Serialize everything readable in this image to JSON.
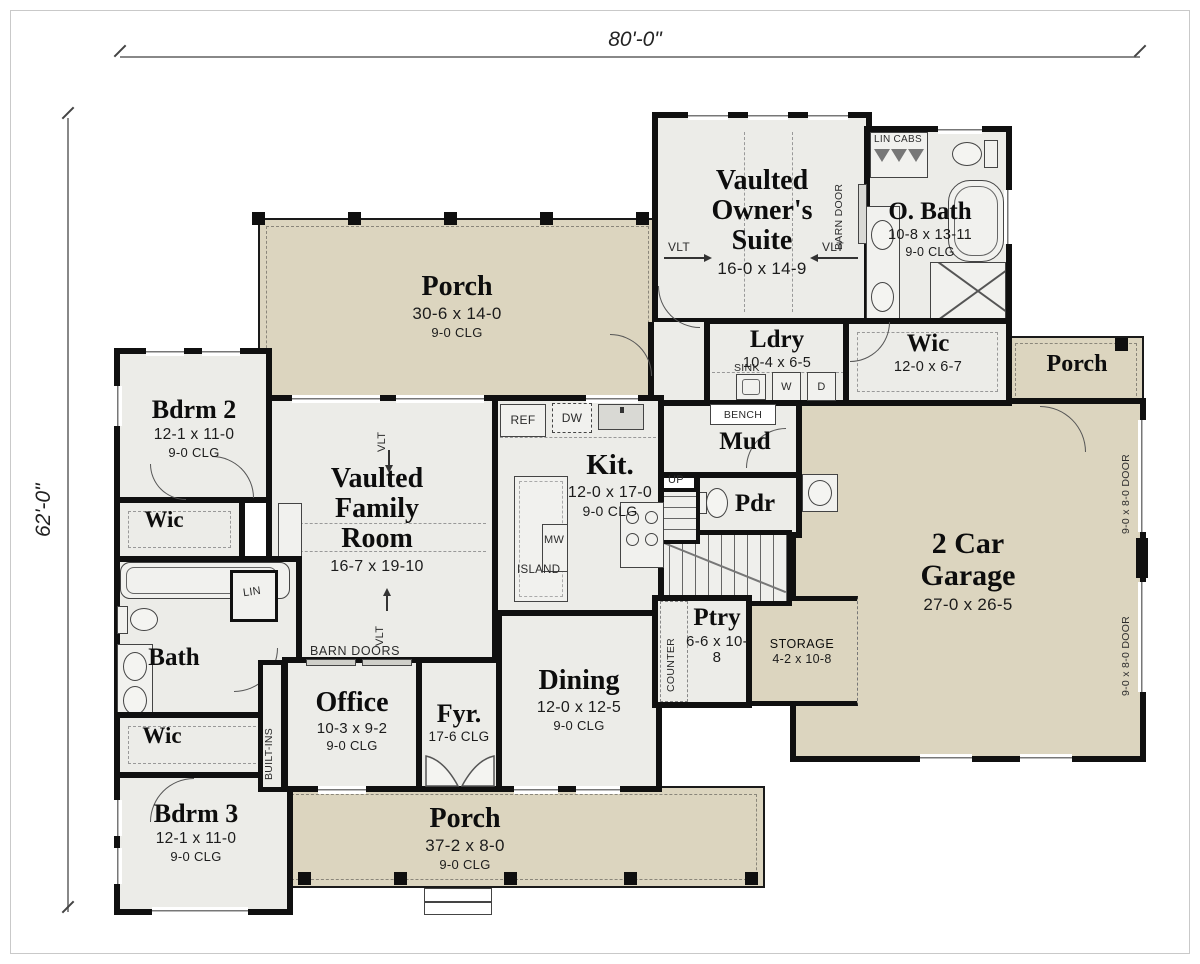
{
  "drawing": {
    "width_dim": "80'-0\"",
    "height_dim": "62'-0\""
  },
  "rooms": {
    "porch_top": {
      "name": "Porch",
      "dims": "30-6 x 14-0",
      "clg": "9-0 CLG"
    },
    "owners_suite": {
      "name": "Vaulted Owner's Suite",
      "dims": "16-0 x 14-9"
    },
    "owners_bath": {
      "name": "O. Bath",
      "dims": "10-8 x 13-11",
      "clg": "9-0 CLG"
    },
    "laundry": {
      "name": "Ldry",
      "dims": "10-4 x 6-5"
    },
    "owners_wic": {
      "name": "Wic",
      "dims": "12-0 x 6-7"
    },
    "porch_right": {
      "name": "Porch"
    },
    "mud": {
      "name": "Mud"
    },
    "powder": {
      "name": "Pdr"
    },
    "garage": {
      "name": "2 Car Garage",
      "dims": "27-0 x 26-5"
    },
    "storage": {
      "name": "STORAGE",
      "dims": "4-2 x 10-8"
    },
    "kitchen": {
      "name": "Kit.",
      "dims": "12-0 x 17-0",
      "clg": "9-0 CLG"
    },
    "family": {
      "name": "Vaulted Family Room",
      "dims": "16-7 x 19-10"
    },
    "bdrm2": {
      "name": "Bdrm 2",
      "dims": "12-1 x 11-0",
      "clg": "9-0 CLG"
    },
    "bdrm2_wic": {
      "name": "Wic"
    },
    "bath2": {
      "name": "Bath"
    },
    "bdrm3_wic": {
      "name": "Wic"
    },
    "bdrm3": {
      "name": "Bdrm 3",
      "dims": "12-1 x 11-0",
      "clg": "9-0 CLG"
    },
    "office": {
      "name": "Office",
      "dims": "10-3 x 9-2",
      "clg": "9-0 CLG"
    },
    "foyer": {
      "name": "Fyr.",
      "clg": "17-6 CLG"
    },
    "dining": {
      "name": "Dining",
      "dims": "12-0 x 12-5",
      "clg": "9-0 CLG"
    },
    "pantry": {
      "name": "Ptry",
      "dims": "6-6 x 10-8"
    },
    "porch_bottom": {
      "name": "Porch",
      "dims": "37-2 x 8-0",
      "clg": "9-0 CLG"
    }
  },
  "annotations": {
    "lin_cabs": "LIN CABS",
    "barn_door": "BARN DOOR",
    "barn_doors": "BARN DOORS",
    "sink": "SINK",
    "washer": "W",
    "dryer": "D",
    "bench": "BENCH",
    "up": "UP",
    "ref": "REF",
    "dw": "DW",
    "mw": "MW",
    "island": "ISLAND",
    "counter": "COUNTER",
    "built_ins": "BUILT-INS",
    "lin": "LIN",
    "vlt": "VLT",
    "garage_door": "9-0 x 8-0 DOOR"
  },
  "colors": {
    "porch_fill": "#dcd5bf",
    "room_fill": "#ecece8",
    "wall": "#101010"
  }
}
